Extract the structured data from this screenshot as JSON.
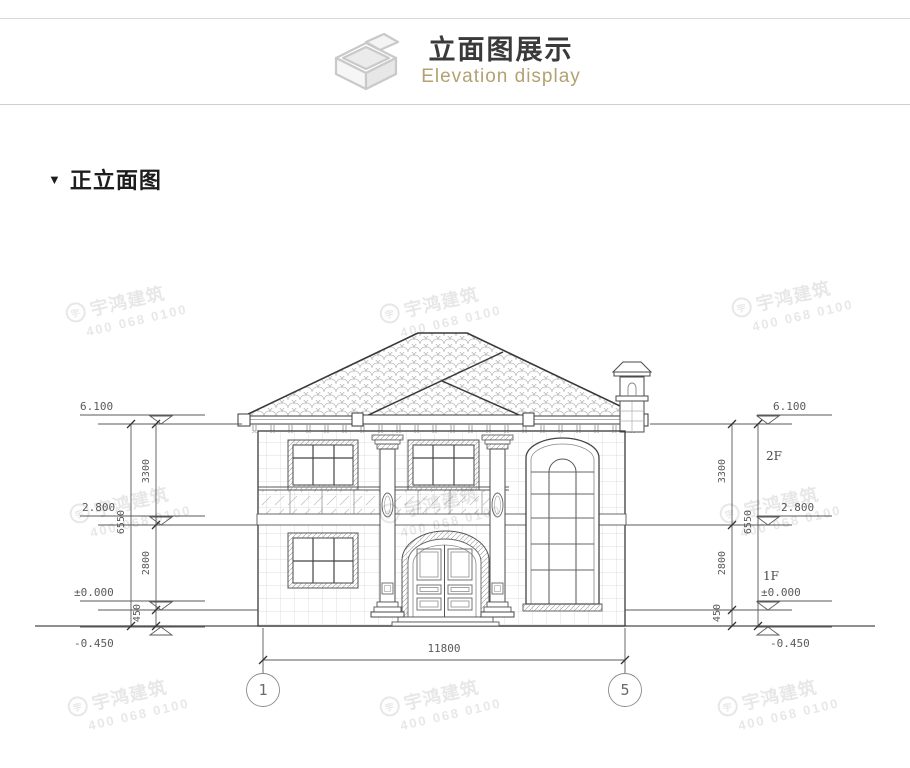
{
  "header": {
    "title": "立面图展示",
    "subtitle": "Elevation display",
    "icon": "isometric-box-icon",
    "accent_color": "#b3a172"
  },
  "section": {
    "marker": "▼",
    "title": "正立面图"
  },
  "drawing": {
    "type": "architectural front elevation",
    "levels": {
      "roof": "6.100",
      "second_floor": "2.800",
      "zero": "±0.000",
      "ground": "-0.450"
    },
    "heights": {
      "upper": "3300",
      "lower": "2800",
      "plinth": "450",
      "total": "6550"
    },
    "floor_labels": {
      "second": "2F",
      "first": "1F"
    },
    "width_dim": "11800",
    "axis_bubbles": {
      "left": "1",
      "right": "5"
    }
  },
  "watermark": {
    "logo": "宇",
    "name": "宇鸿建筑",
    "phone": "400 068 0100"
  }
}
